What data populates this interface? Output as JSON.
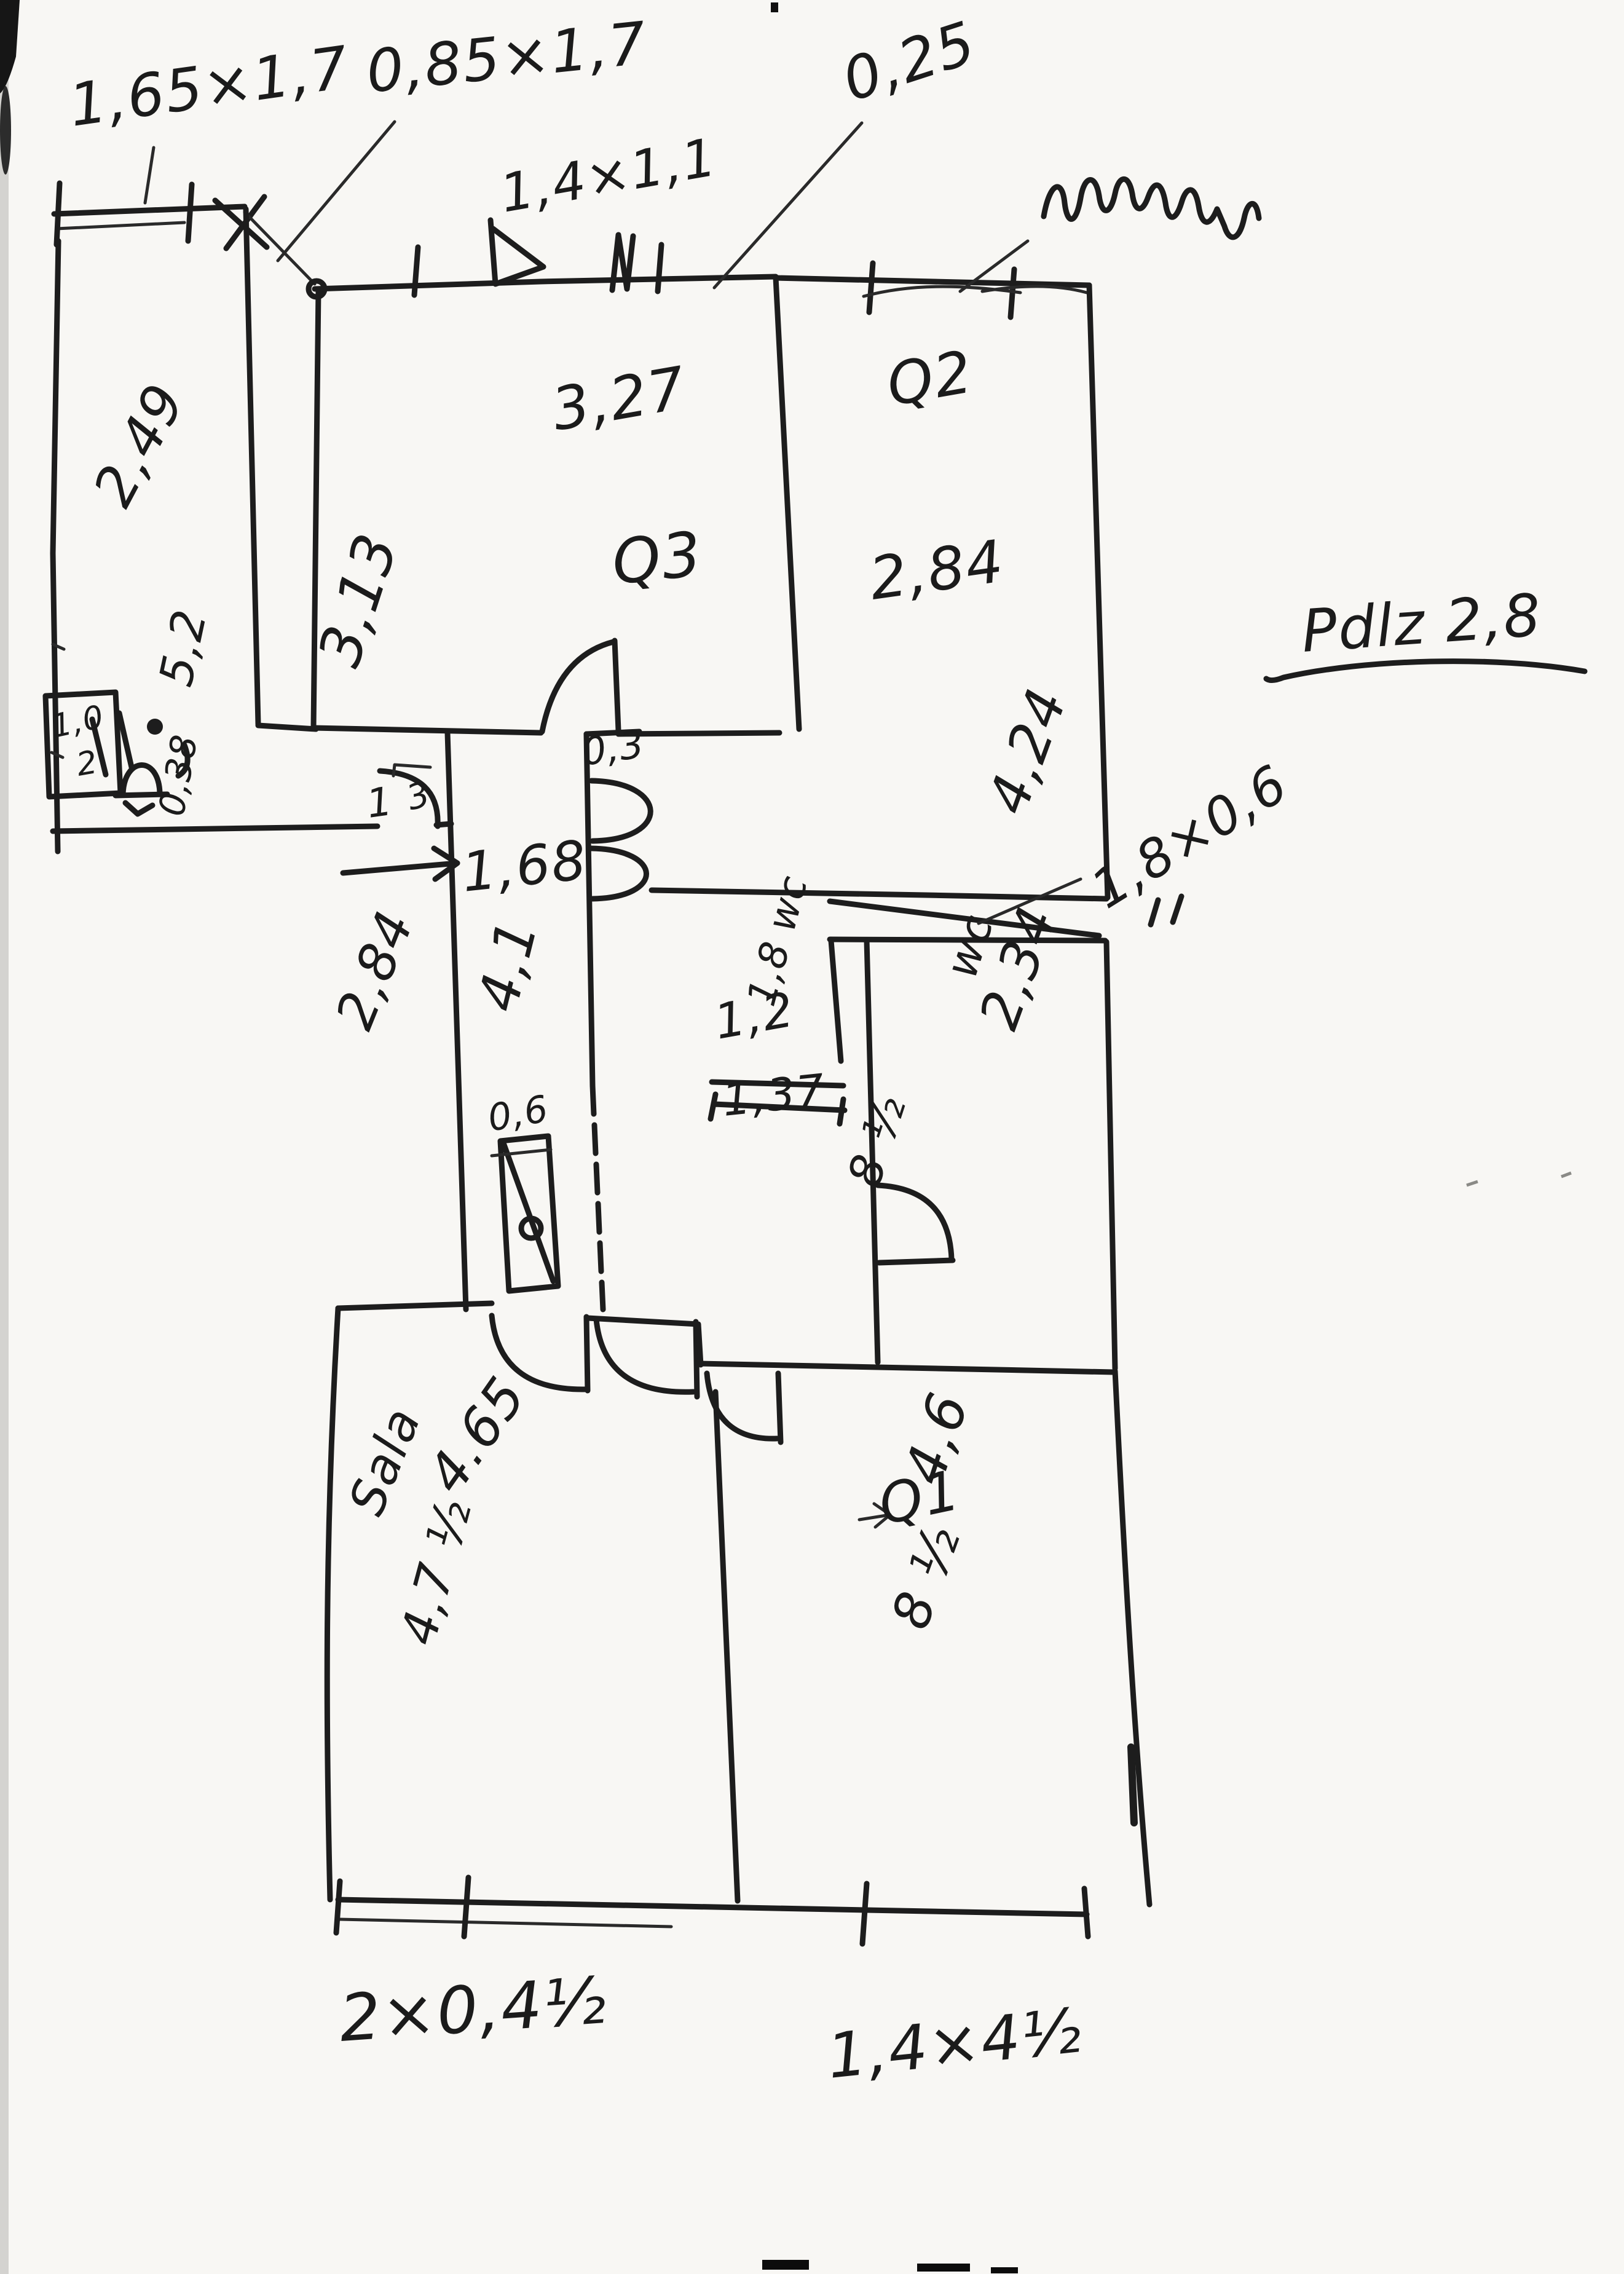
{
  "page": {
    "title": "Odreczny szkic rzutu mieszkania",
    "paper_color": "#f8f7f4",
    "ink_color": "#1d1d1d"
  },
  "notes": {
    "floor_height": "Pdlz 2,8",
    "vent": "0,25"
  },
  "windows": {
    "top_left_large": "1,65×1,7",
    "top_left_small": "0,85×1,7",
    "room_q3": "1,4×1,1",
    "wc": "1,8×0,6",
    "bottom_left": "2×0,4½",
    "bottom_right": "1,4×4½"
  },
  "rooms": {
    "left": {
      "width": "2,49",
      "depth": "5,2"
    },
    "q3": {
      "name": "Q3",
      "width": "3,27",
      "depth": "3,13"
    },
    "q2": {
      "name": "Q2",
      "width": "2,84",
      "depth": "4,24"
    },
    "hall": {
      "width": "1,68",
      "length": "4,1",
      "side": "2,84",
      "step": "0,3",
      "wall": "0,38",
      "door_left": "1",
      "door_mark": "3",
      "radiator": "0,6"
    },
    "wc_small": {
      "label": "1,8 wc",
      "width": "1,2",
      "length": "1,37"
    },
    "wc_large": {
      "label": "wc",
      "length": "2,34",
      "door": "8 ½"
    },
    "sala": {
      "name": "Sala",
      "width": "4.65",
      "bottom": "4,7 ½"
    },
    "q1": {
      "name": "Q1",
      "width": "4,6",
      "bottom": "8 ½"
    }
  },
  "fixtures": {
    "cabinet_a": "1,0",
    "cabinet_b": "2"
  }
}
